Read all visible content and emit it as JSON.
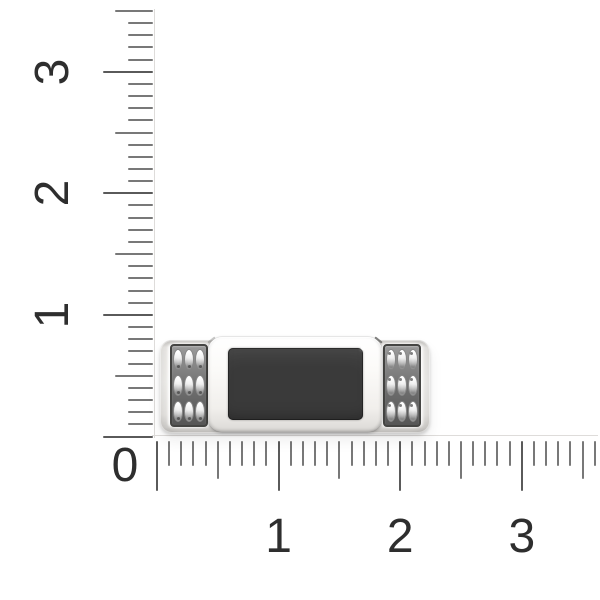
{
  "scene": {
    "description": "Silver jewelry plaque with black rectangular onyx inlay and two 3x3 beaded side panels, photographed on white behind centimeter rulers"
  },
  "rulers": {
    "origin_label": "0",
    "vertical": {
      "labels": [
        {
          "text": "1",
          "value": 1
        },
        {
          "text": "2",
          "value": 2
        },
        {
          "text": "3",
          "value": 3
        }
      ],
      "max_value": 3.5,
      "minor_ticks_per_unit": 10
    },
    "horizontal": {
      "labels": [
        {
          "text": "1",
          "value": 1
        },
        {
          "text": "2",
          "value": 2
        },
        {
          "text": "3",
          "value": 3
        }
      ],
      "max_value": 3.6,
      "minor_ticks_per_unit": 10
    }
  },
  "item": {
    "name": "silver plaque with black inlay and beaded side panels",
    "bead_grid": {
      "rows": 3,
      "columns": 3
    }
  },
  "theme": {
    "background": "#ffffff",
    "tick_color": "#787878",
    "tick_strong_color": "#5a5a5a",
    "ruler_line_color": "#dedcda",
    "label_color": "#2e2e2e",
    "panel_color": "#6d6d6d",
    "inlay_color": "#3a3a3a"
  }
}
